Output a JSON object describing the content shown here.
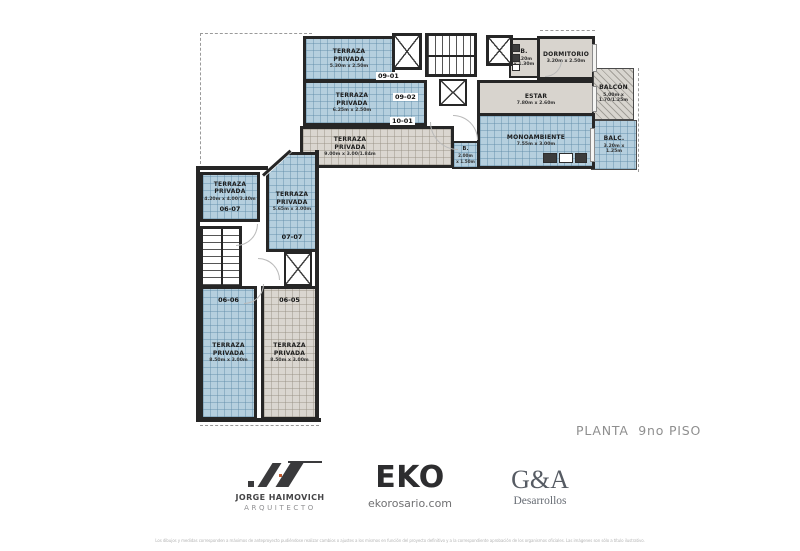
{
  "plan": {
    "caption": "PLANTA  9no PISO",
    "rooms": {
      "t0901": {
        "label": "TERRAZA\nPRIVADA",
        "dims": "5.30m x 2.50m",
        "unit": "09-01"
      },
      "t0902": {
        "label": "TERRAZA\nPRIVADA",
        "dims": "6.25m x 2.50m",
        "unit": "09-02"
      },
      "t1001": {
        "label": "TERRAZA\nPRIVADA",
        "dims": "9.00m x 3.00/1.84m",
        "unit": "10-01"
      },
      "dorm": {
        "label": "DORMITORIO",
        "dims": "3.20m x 2.50m"
      },
      "bdorm": {
        "label": "B.",
        "dims": "2.20m\nx 1.30m"
      },
      "estar": {
        "label": "ESTAR",
        "dims": "7.80m x 2.60m"
      },
      "balcon": {
        "label": "BALCÓN",
        "dims": "5.00m x\n1.70/1.25m"
      },
      "balc": {
        "label": "BALC.",
        "dims": "3.20m x\n1.25m"
      },
      "mono": {
        "label": "MONOAMBIENTE",
        "dims": "7.55m x 3.00m"
      },
      "bmono": {
        "label": "B.",
        "dims": "2.00m\nx 1.50m"
      },
      "t0607": {
        "label": "TERRAZA\nPRIVADA",
        "dims": "4.20m x 4.00/3.40m",
        "unit": "06-07"
      },
      "t0707": {
        "label": "TERRAZA\nPRIVADA",
        "dims": "5.65m x 3.00m",
        "unit": "07-07"
      },
      "t0606": {
        "label": "TERRAZA\nPRIVADA",
        "dims": "8.50m x 3.00m",
        "unit": "06-06"
      },
      "t0605": {
        "label": "TERRAZA\nPRIVADA",
        "dims": "8.50m x 3.00m",
        "unit": "06-05"
      }
    }
  },
  "footer": {
    "architect": {
      "name": "JORGE HAIMOVICH",
      "role": "ARQUITECTO"
    },
    "brand": {
      "name": "EKO",
      "site": "ekorosario.com"
    },
    "developer": {
      "name": "G&A",
      "sub": "Desarrollos"
    },
    "disclaimer": "Los dibujos y medidas corresponden a máximos de anteproyecto pudiéndose realizar cambios o ajustes a los mismos en función del proyecto definitivo y a la correspondiente aprobación de los organismos oficiales. Las imágenes son sólo a título ilustrativo."
  },
  "colors": {
    "terrace_blue": "#b5cfde",
    "floor_grey": "#d8d4ce",
    "wall": "#262626",
    "caption_grey": "#8f8f8f",
    "accent_orange": "#c05a30"
  }
}
